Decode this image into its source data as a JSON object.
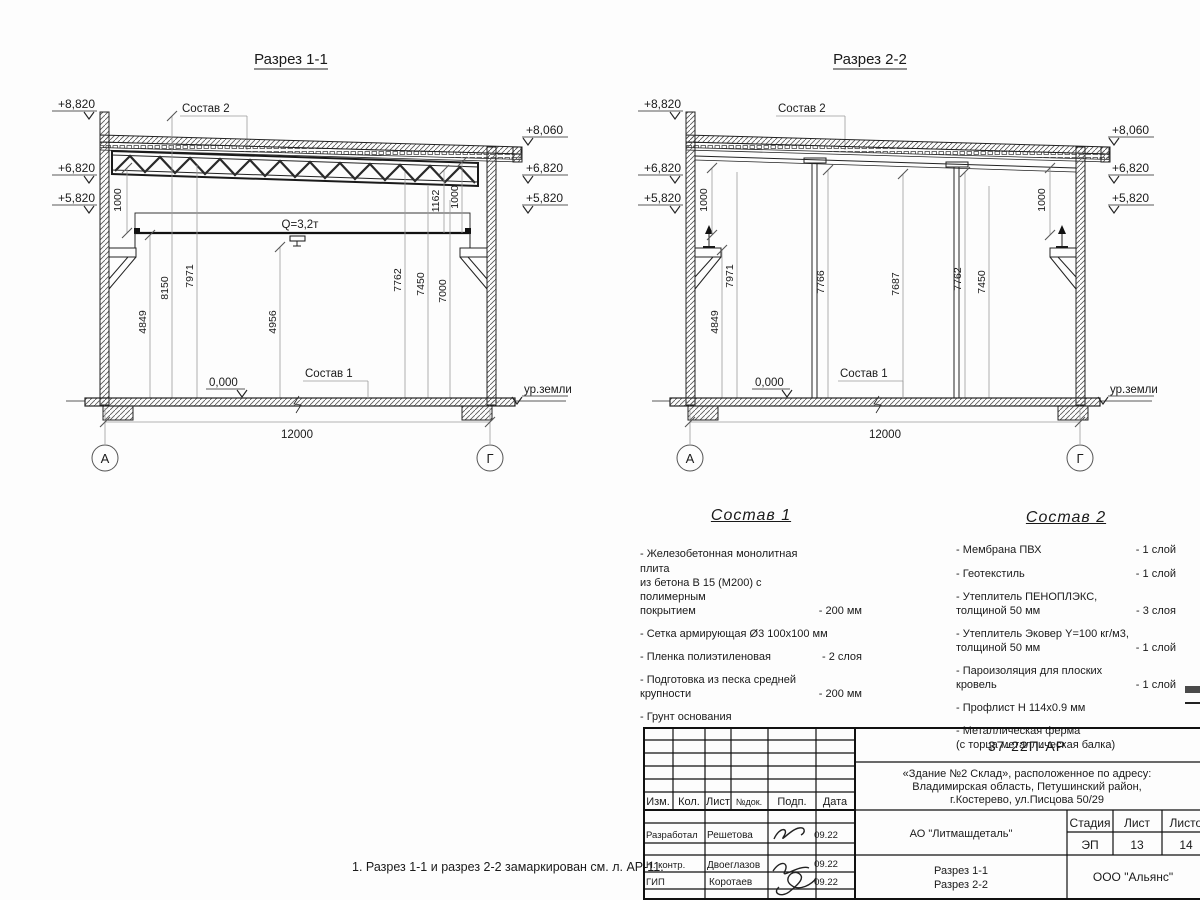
{
  "note": "1. Разрез 1-1 и разрез 2-2 замаркирован см. л. АР-11.",
  "section1": {
    "title": "Разрез 1-1",
    "sostav2_label": "Состав 2",
    "sostav1_label": "Состав 1",
    "crane_label": "Q=3,2т",
    "zero_mark": "0,000",
    "ground_label": "ур.земли",
    "span_dim": "12000",
    "axis_left": "А",
    "axis_right": "Г",
    "elev_left": [
      "+8,820",
      "+6,820",
      "+5,820"
    ],
    "elev_right": [
      "+8,060",
      "+6,820",
      "+5,820"
    ],
    "dims": [
      "4849",
      "8150",
      "7971",
      "4956",
      "7762",
      "7450",
      "7000"
    ],
    "small_dims": [
      "1000",
      "1162",
      "1000"
    ]
  },
  "section2": {
    "title": "Разрез 2-2",
    "sostav2_label": "Состав 2",
    "sostav1_label": "Состав 1",
    "zero_mark": "0,000",
    "ground_label": "ур.земли",
    "span_dim": "12000",
    "axis_left": "А",
    "axis_right": "Г",
    "elev_left": [
      "+8,820",
      "+6,820",
      "+5,820"
    ],
    "elev_right": [
      "+8,060",
      "+6,820",
      "+5,820"
    ],
    "dims": [
      "4849",
      "7971",
      "7766",
      "7687",
      "7762",
      "7450"
    ],
    "small_dims": [
      "1000",
      "1000"
    ]
  },
  "sostav1": {
    "title": "Состав 1",
    "items": [
      {
        "name": "- Железобетонная  монолитная плита\nиз бетона В 15 (М200) с полимерным\nпокрытием",
        "qty": "- 200 мм"
      },
      {
        "name": "- Сетка армирующая Ø3 100х100 мм",
        "qty": ""
      },
      {
        "name": "- Пленка полиэтиленовая",
        "qty": "- 2 слоя"
      },
      {
        "name": "- Подготовка из песка средней\n  крупности",
        "qty": "- 200 мм"
      },
      {
        "name": "- Грунт основания",
        "qty": ""
      }
    ]
  },
  "sostav2": {
    "title": "Состав 2",
    "items": [
      {
        "name": "- Мембрана ПВХ",
        "qty": "- 1 слой"
      },
      {
        "name": "- Геотекстиль",
        "qty": "- 1 слой"
      },
      {
        "name": "- Утеплитель ПЕНОПЛЭКС,\n  толщиной 50 мм",
        "qty": "- 3 слоя"
      },
      {
        "name": "- Утеплитель Эковер Y=100 кг/м3,\n  толщиной 50 мм",
        "qty": "- 1 слой"
      },
      {
        "name": "- Пароизоляция для плоских кровель",
        "qty": "- 1 слой"
      },
      {
        "name": "- Профлист Н 114х0.9 мм",
        "qty": ""
      },
      {
        "name": "- Металлическая ферма\n  (с торца металлическая балка)",
        "qty": ""
      }
    ]
  },
  "titleblock": {
    "doc_code": "37-22П-АР",
    "object_lines": [
      "«Здание №2 Склад», расположенное по адресу:",
      "Владимирская область, Петушинский район,",
      "г.Костерево, ул.Писцова 50/29"
    ],
    "cols": {
      "izm": "Изм.",
      "kol": "Кол.",
      "list": "Лист",
      "doc": "№док.",
      "sign": "Подп.",
      "date": "Дата"
    },
    "rows": [
      {
        "role": "Разработал",
        "name": "Решетова",
        "date": "09.22"
      },
      {
        "role": "Н. контр.",
        "name": "Двоеглазов",
        "date": "09.22"
      },
      {
        "role": "ГИП",
        "name": "Коротаев",
        "date": "09.22"
      }
    ],
    "company": "АО \"Литмашдеталь\"",
    "stage_label": "Стадия",
    "sheet_label": "Лист",
    "sheets_label": "Листов",
    "stage": "ЭП",
    "sheet": "13",
    "sheets": "14",
    "drawing_titles": [
      "Разрез 1-1",
      "Разрез 2-2"
    ],
    "org": "ООО \"Альянс\""
  }
}
